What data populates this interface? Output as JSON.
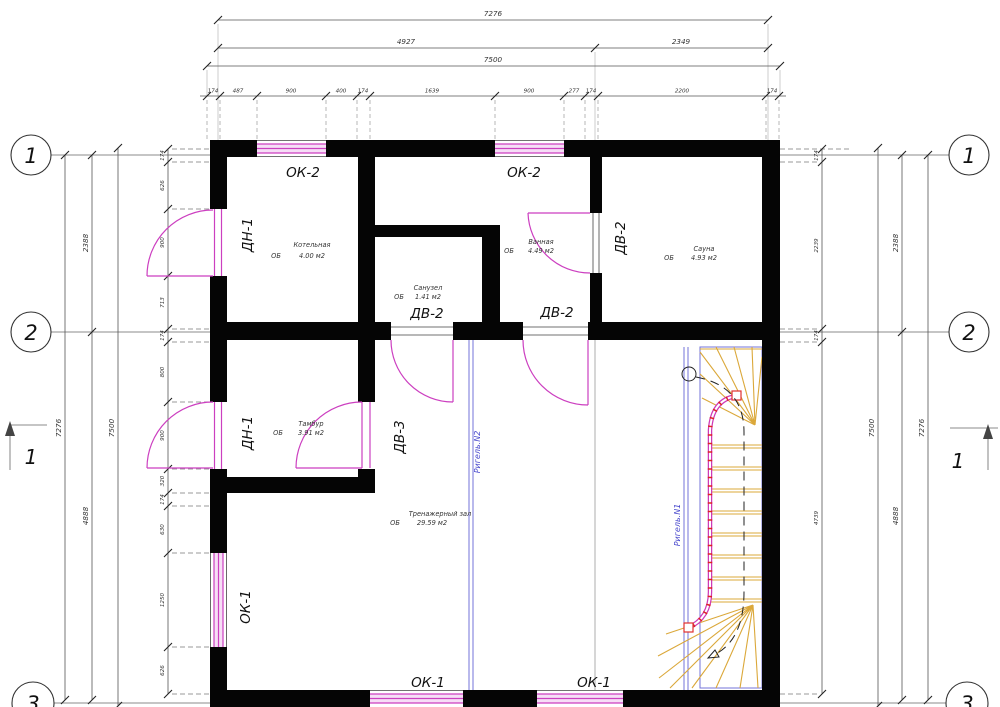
{
  "dims": {
    "top": {
      "overall": "7276",
      "split": [
        "4927",
        "2349"
      ],
      "outer": "7500",
      "detail": [
        "174",
        "487",
        "900",
        "400",
        "174",
        "1639",
        "900",
        "277",
        "174",
        "2200",
        "174"
      ]
    },
    "left": {
      "overall": "7276",
      "outer": "7500",
      "axis": [
        "2388",
        "4888"
      ],
      "upper": [
        "174",
        "626",
        "900",
        "713"
      ],
      "lower": [
        "174",
        "800",
        "900",
        "320",
        "174",
        "630",
        "1250",
        "626"
      ]
    },
    "right": {
      "overall": "7276",
      "outer": "7500",
      "axis": [
        "2388",
        "4888"
      ],
      "detail": [
        "174",
        "2239",
        "174",
        "4739"
      ]
    }
  },
  "axes": {
    "one": "1",
    "two": "2",
    "three": "3"
  },
  "section": {
    "label": "1"
  },
  "labels": {
    "ok1": "ОК-1",
    "ok2": "ОК-2",
    "dn1": "ДН-1",
    "dv2": "ДВ-2",
    "dv3": "ДВ-3"
  },
  "beams": {
    "n1": "Ригель.N1",
    "n2": "Ригель.N2"
  },
  "rooms": [
    {
      "name": "Котельная",
      "ob": "ОБ",
      "area": "4.00 м2"
    },
    {
      "name": "Санузел",
      "ob": "ОБ",
      "area": "1.41 м2"
    },
    {
      "name": "Ванная",
      "ob": "ОБ",
      "area": "4.49 м2"
    },
    {
      "name": "Сауна",
      "ob": "ОБ",
      "area": "4.93 м2"
    },
    {
      "name": "Тамбур",
      "ob": "ОБ",
      "area": "3.91 м2"
    },
    {
      "name": "Тренажерный зал",
      "ob": "ОБ",
      "area": "29.59 м2"
    }
  ],
  "colors": {
    "wall": "#050505",
    "opening": "#cc3fc0",
    "beam": "#5b5bd6",
    "tread": "#dba83a",
    "dimension": "#555555"
  }
}
